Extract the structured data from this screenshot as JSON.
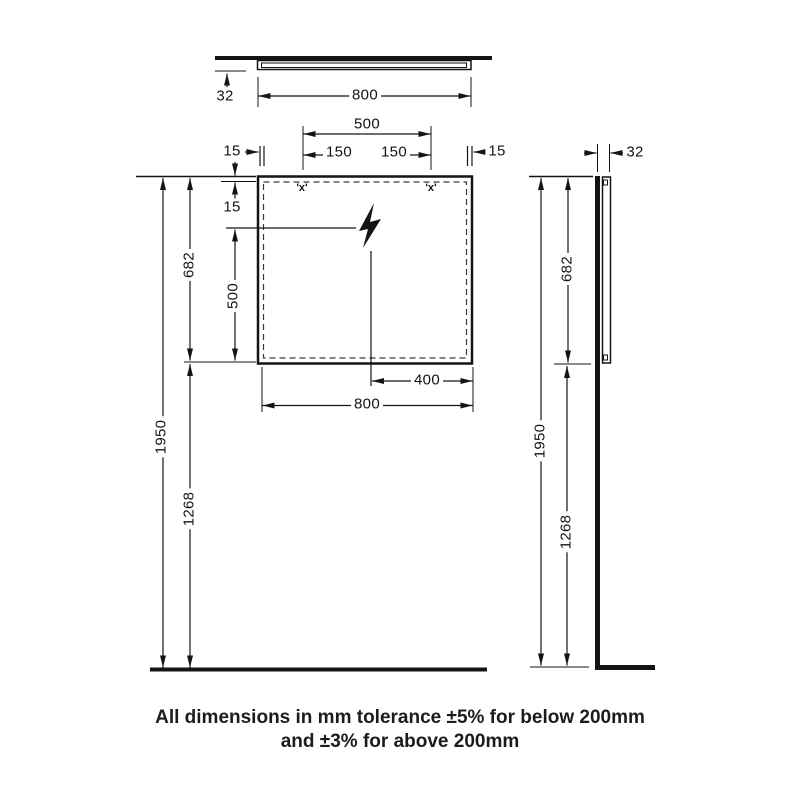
{
  "top_view": {
    "depth": "32",
    "width": "800"
  },
  "front_view": {
    "mount_span": "500",
    "mount_left": "150",
    "mount_right": "150",
    "inset_left": "15",
    "inset_right": "15",
    "inset_top": "15",
    "drop_to_bottom": "500",
    "mirror_height": "682",
    "total_height": "1950",
    "floor_to_mirror": "1268",
    "cable_offset": "400",
    "mirror_width": "800",
    "mount_marker": "'x'"
  },
  "side_view": {
    "depth": "32",
    "mirror_height": "682",
    "total_height": "1950",
    "floor_to_mirror": "1268"
  },
  "footnote": {
    "line1": "All dimensions in mm tolerance ±5% for below 200mm",
    "line2": "and ±3% for above 200mm"
  }
}
